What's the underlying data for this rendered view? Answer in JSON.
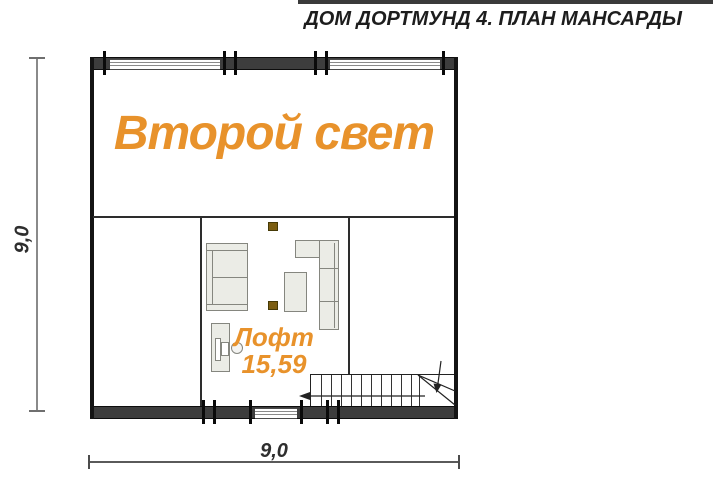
{
  "title": "ДОМ ДОРТМУНД 4. ПЛАН МАНСАРДЫ",
  "plan": {
    "upper_room": {
      "label": "Второй свет"
    },
    "loft_room": {
      "label": "Лофт",
      "area": "15,59"
    },
    "dimensions": {
      "width_label": "9,0",
      "height_label": "9,0"
    }
  },
  "colors": {
    "accent_orange": "#E8922B",
    "wall_dark": "#3D3D3D",
    "furniture_fill": "#EBECE6",
    "post_brown": "#7C5E11",
    "dimension_gray": "#8A8A8A"
  }
}
